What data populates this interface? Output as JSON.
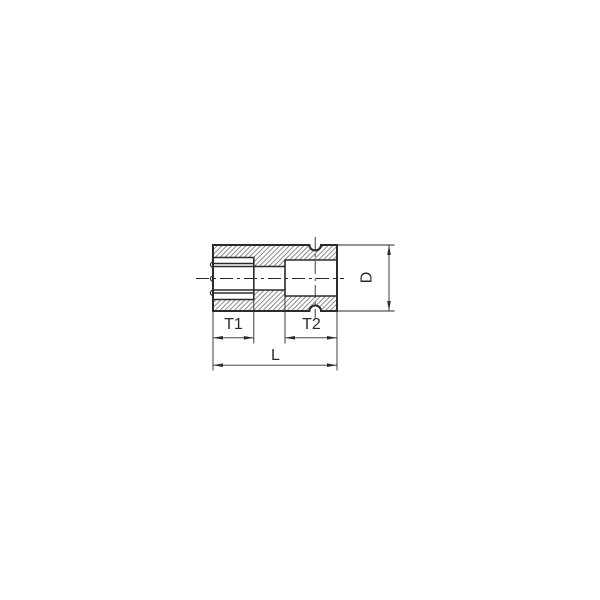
{
  "drawing": {
    "title": "socket cross-section technical drawing",
    "description": "Side cross-section view of a 12-point socket with square drive, hatched section, centerlines and four dimensions",
    "labels": {
      "t1": "T1",
      "t2": "T2",
      "length": "L",
      "diameter": "D"
    },
    "colors": {
      "background": "#ffffff",
      "line": "#2b2b2b",
      "hatch": "#6b6b6b"
    }
  }
}
